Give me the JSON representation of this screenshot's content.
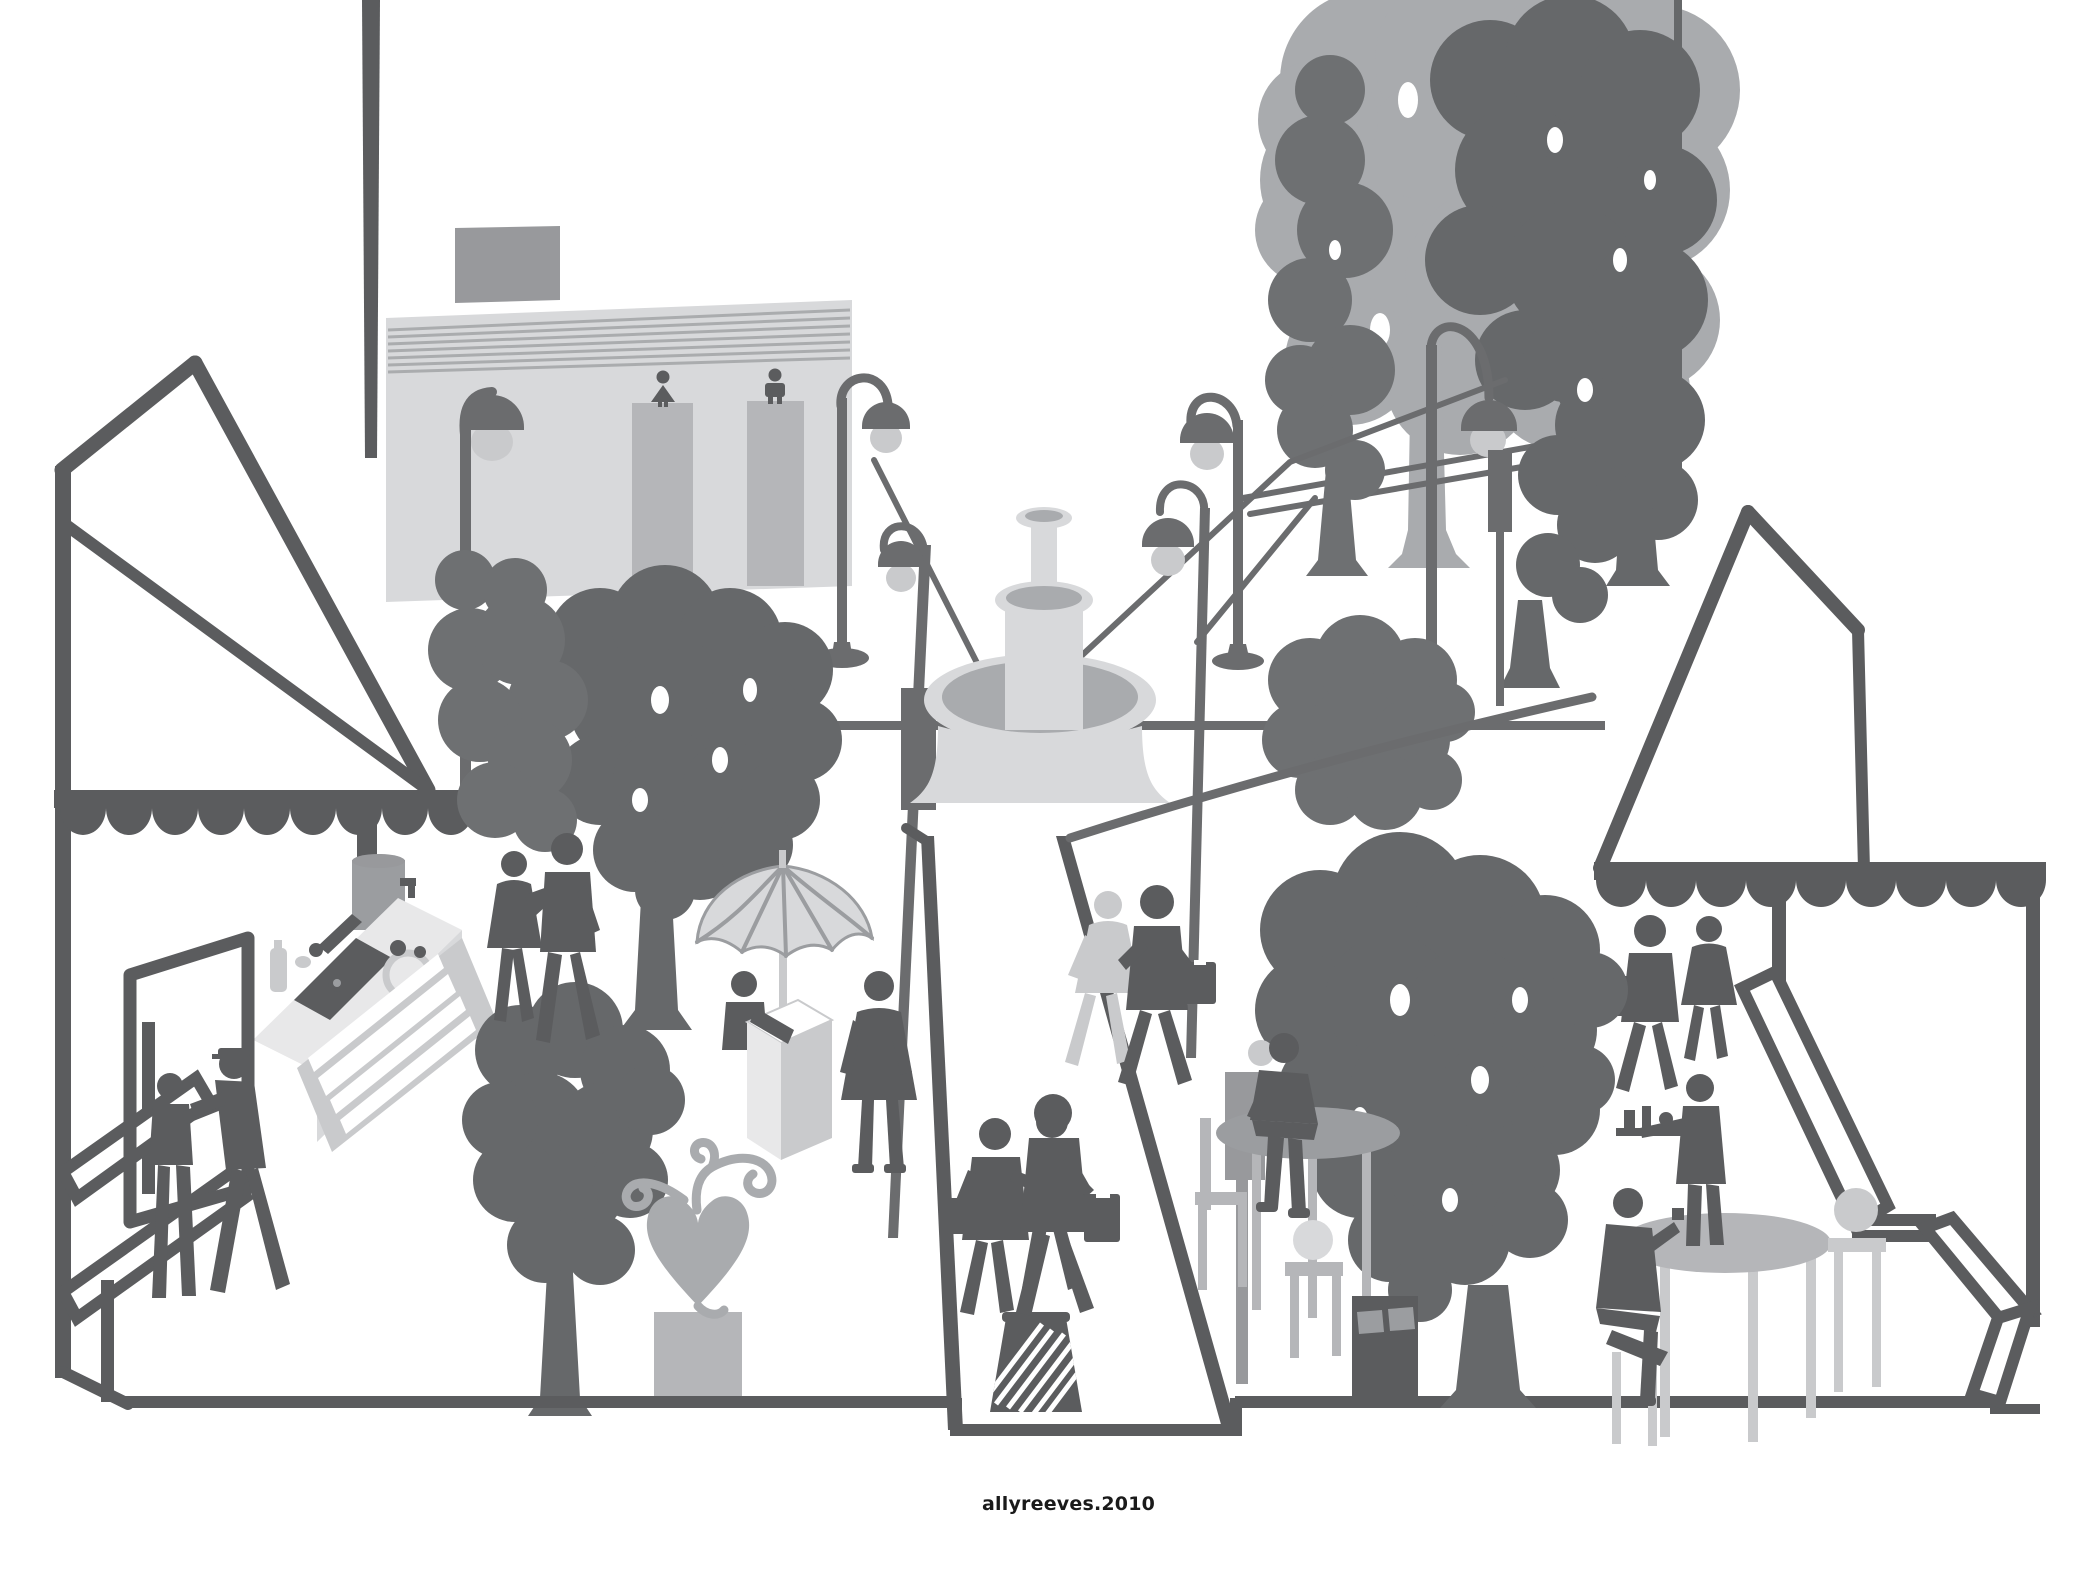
{
  "artwork": {
    "signature": "allyreeves.2010",
    "kind": "public-plaza illustration, grayscale silhouette style"
  },
  "palette": {
    "bg": "#ffffff",
    "ink": "#1a1a1a",
    "dark": "#5b5c5e",
    "lamp": "#6b6c6e",
    "tree_dark": "#66686a",
    "tree_mid": "#6e7072",
    "mid": "#98999c",
    "gray": "#9b9da0",
    "silver": "#a9abae",
    "light": "#b5b6b9",
    "lighter": "#c9cacc",
    "pale": "#d8d9db",
    "paler": "#e8e8e9",
    "white": "#ffffff",
    "hatch": "#aaacae"
  },
  "scene": {
    "elements": [
      "restroom-building with female and male door pictograms",
      "tiered plaza fountain",
      "gooseneck street lamps with overhead wires",
      "market tent with scalloped awning and espresso coffee bar",
      "umbrella vendor cart with customer",
      "heart sculpture on pedestal",
      "central pedestrian path with walking couples and hatched litter bin",
      "cafe terrace: round tables, chairs, menu signpost, recycling bin, waiter with tray, seated patrons",
      "second tent with scalloped awning and outlined stairs",
      "tree grove in greys"
    ]
  }
}
